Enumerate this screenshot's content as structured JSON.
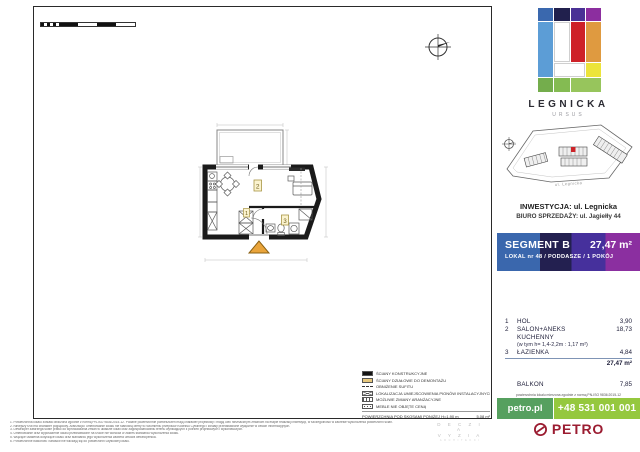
{
  "logo": {
    "title": "LEGNICKA",
    "subtitle": "URSUS"
  },
  "map": {
    "street_label": "ul. Legnicka"
  },
  "captions": {
    "investment": "INWESTYCJA: ul. Legnicka",
    "sales_office": "BIURO SPRZEDAŻY: ul. Jagiełły 44"
  },
  "segment": {
    "name": "SEGMENT B",
    "area": "27,47 m²",
    "details": "LOKAL nr 48  /  PODDASZE  / 1 POKÓJ",
    "gradient_colors": [
      "#3a67ad",
      "#232050",
      "#46309c",
      "#8b2fa0"
    ]
  },
  "rooms": {
    "rows": [
      {
        "no": "1",
        "name": "HOL",
        "area": "3,90"
      },
      {
        "no": "2",
        "name": "SALON+ANEKS KUCHENNY",
        "area": "18,73",
        "note": "(w tym h= 1,4-2,2m : 1,17 m²)"
      },
      {
        "no": "3",
        "name": "ŁAZIENKA",
        "area": "4,84"
      }
    ],
    "total": "27,47 m²",
    "balcony_label": "BALKON",
    "balcony_area": "7,85"
  },
  "norm_note": "powierzchnia lokalu mierzona zgodnie z normą PN-ISO 9836:2015-12",
  "contact": {
    "website": "petro.pl",
    "phone": "+48 531 001 001",
    "bar_colors": [
      "#56a05f",
      "#95c83e"
    ]
  },
  "brand": {
    "name": "PETRO",
    "color": "#9b1c31"
  },
  "plan": {
    "room_tags": {
      "hall": "1",
      "salon": "2",
      "bathroom": "3"
    },
    "entrance_triangle_color": "#e9a43b"
  },
  "legend": {
    "items": [
      {
        "label": "ŚCIANY KONSTRUKCYJNE"
      },
      {
        "label": "ŚCIANY DZIAŁOWE DO DEMONTAŻU"
      },
      {
        "label": "OBNIŻENIE SUFITU"
      },
      {
        "label": "LOKALIZACJA UMIEJSCOWIENIA PIONÓW INSTALACYJNYCH"
      },
      {
        "label": "MOŻLIWE ZMIANY ARANŻACYJNE"
      },
      {
        "label": "MEBLE NIE OBJĘTE CENĄ"
      }
    ],
    "footer_label": "POWIERZCHNIA POD SKOSAMI PONIŻEJ H=1,90 m",
    "footer_value": "5,08 m²"
  },
  "disclaimer_lines": [
    "1. Powierzchnia lokalu została obliczona zgodnie z normą PN-ISO 9836:2015-12. Podane powierzchnie pomieszczeń mają charakter projektowy i mogą ulec nieznacznym zmianom na etapie realizacji inwestycji, w szczególności w zakresie wykończenia powierzchni ścian.",
    "2. Niniejszy rzut ma charakter poglądowy. Aranżacja i umeblowanie lokalu nie stanowią oferty w rozumieniu przepisów Kodeksu Cywilnego i zostały przedstawione wyłącznie w celach informacyjnych.",
    "3. Deweloper zastrzega sobie prawo do wprowadzania zmian w układzie lokali oraz zagospodarowaniu terenu wynikających z potrzeb projektowych i wykonawczych.",
    "4. Umeblowanie oraz wyposażenie lokalu przedstawione na rzucie nie wchodzi w zakres standardu wykończenia lokalu.",
    "5. Wiążące ustalenia dotyczące lokalu oraz standardu jego wykończenia zawiera umowa deweloperska.",
    "6. Powierzchnie balkonów i tarasów nie wliczają się do powierzchni użytkowej lokalu."
  ],
  "studio_mark": {
    "line1": "D E C Z I A",
    "line2": "V Y Z I A",
    "line3": "A R C H I T E K C I"
  }
}
